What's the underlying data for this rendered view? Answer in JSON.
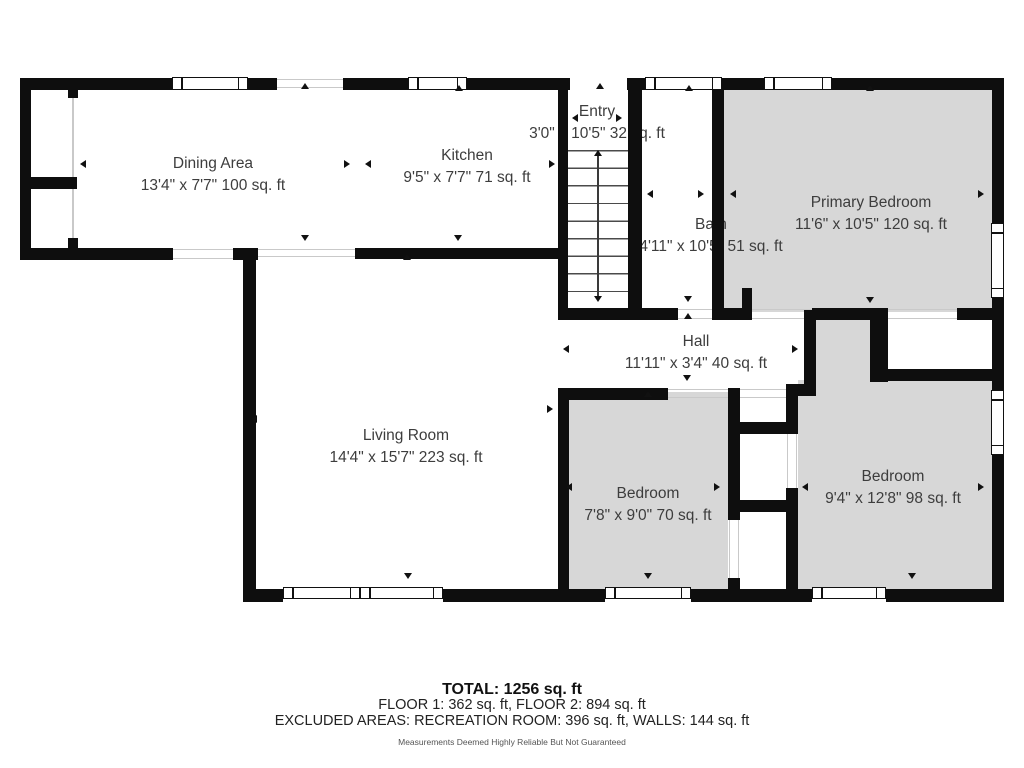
{
  "rooms": {
    "dining": {
      "name": "Dining Area",
      "dims": "13'4\" x 7'7\" 100 sq. ft"
    },
    "kitchen": {
      "name": "Kitchen",
      "dims": "9'5\" x 7'7\" 71 sq. ft"
    },
    "entry": {
      "name": "Entry",
      "dims": "3'0\" x 10'5\" 32 sq. ft"
    },
    "bath": {
      "name": "Bath",
      "dims": "4'11\" x 10'5\" 51 sq. ft"
    },
    "primary": {
      "name": "Primary Bedroom",
      "dims": "11'6\" x 10'5\" 120 sq. ft"
    },
    "hall": {
      "name": "Hall",
      "dims": "11'11\" x 3'4\" 40 sq. ft"
    },
    "living": {
      "name": "Living Room",
      "dims": "14'4\" x 15'7\" 223 sq. ft"
    },
    "bedroom1": {
      "name": "Bedroom",
      "dims": "7'8\" x 9'0\" 70 sq. ft"
    },
    "bedroom2": {
      "name": "Bedroom",
      "dims": "9'4\" x 12'8\" 98 sq. ft"
    }
  },
  "summary": {
    "total": "TOTAL: 1256 sq. ft",
    "floors": "FLOOR 1: 362 sq. ft, FLOOR 2: 894 sq. ft",
    "excluded": "EXCLUDED AREAS: RECREATION ROOM: 396 sq. ft, WALLS: 144 sq. ft",
    "disclaimer": "Measurements Deemed Highly Reliable But Not Guaranteed"
  },
  "colors": {
    "wall": "#0e0e0e",
    "room_fill": "#d7d7d7",
    "text": "#3d3d3d"
  }
}
